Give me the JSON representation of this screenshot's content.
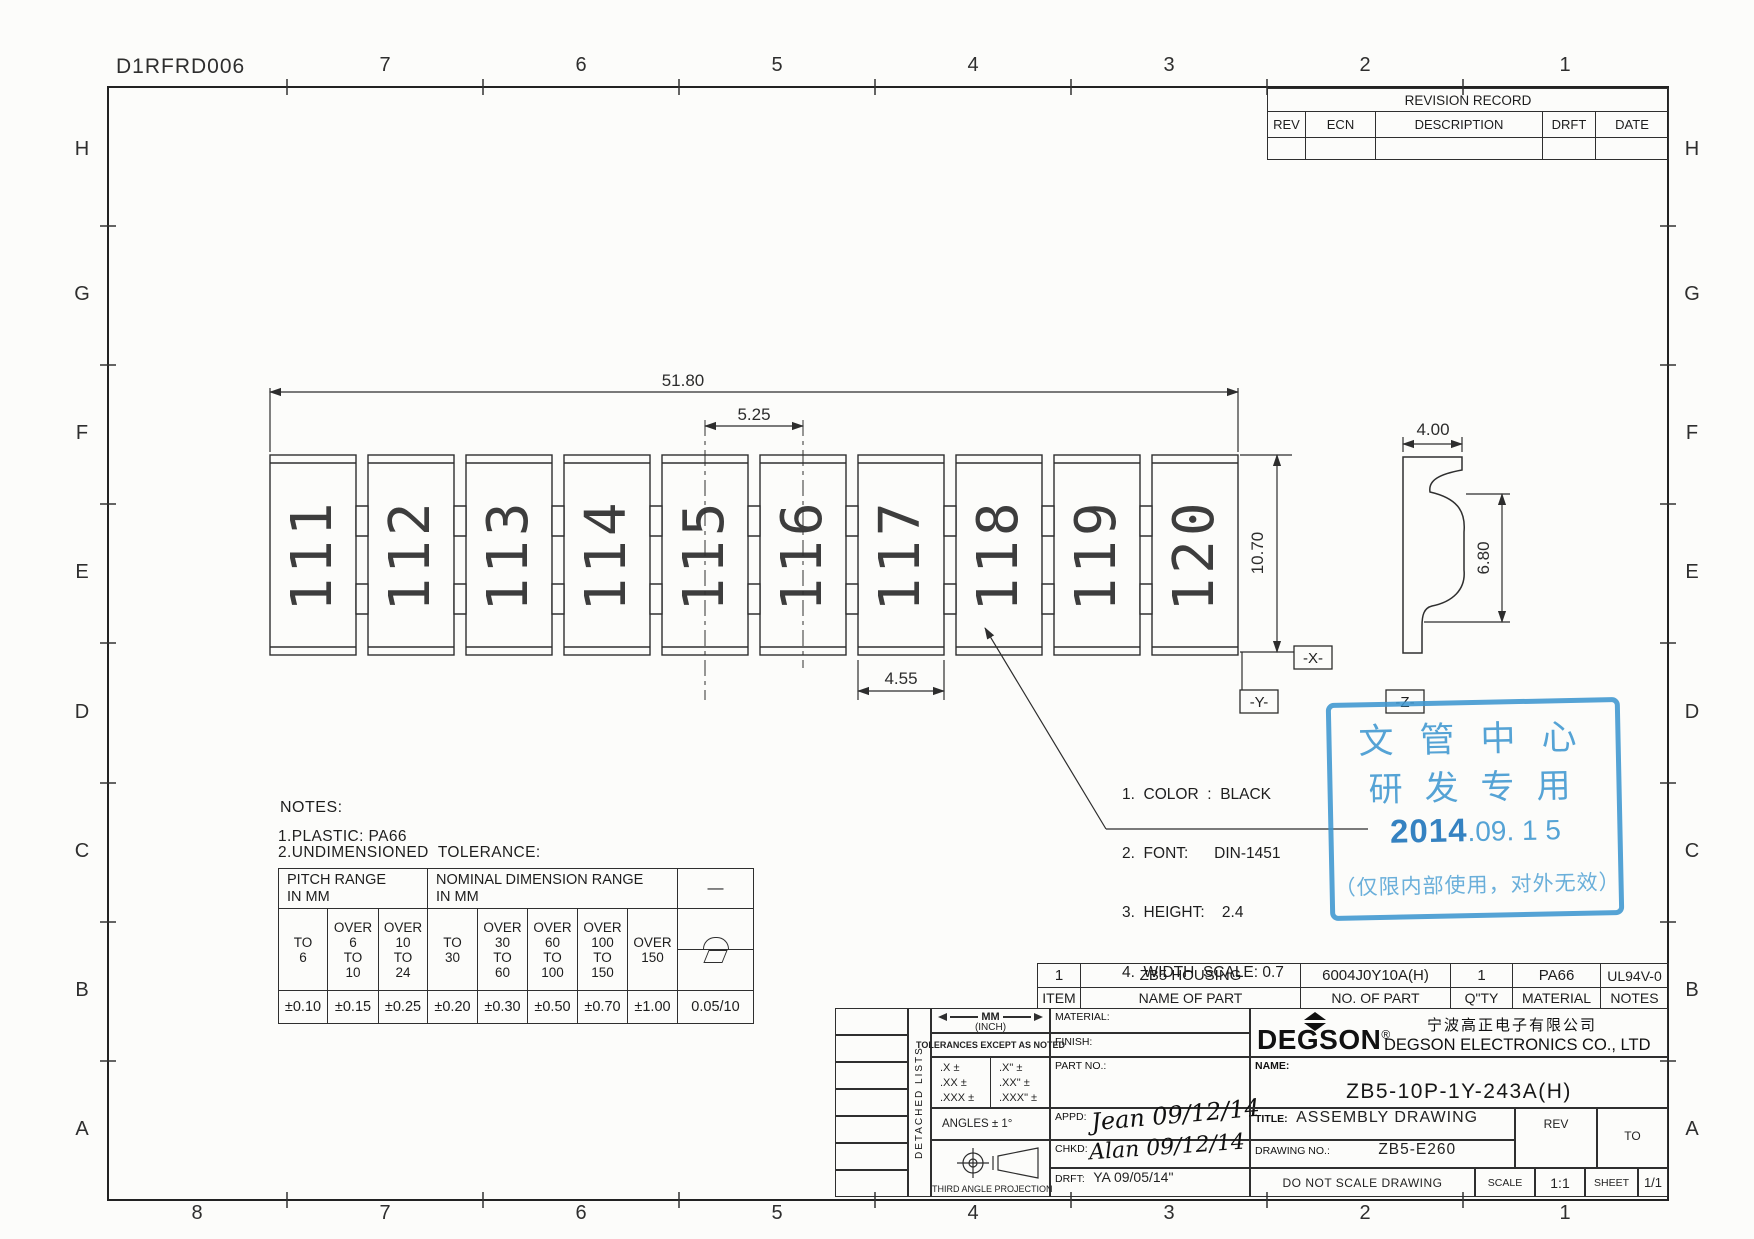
{
  "colors": {
    "line": "#2f2f2f",
    "stamp_blue": "#3e97d0",
    "stamp_date_blue": "#1a72ba"
  },
  "sheet": {
    "doc_number": "D1RFRD006",
    "grid_letters": [
      "H",
      "G",
      "F",
      "E",
      "D",
      "C",
      "B",
      "A"
    ],
    "top_numbers": [
      "7",
      "6",
      "5",
      "4",
      "3",
      "2",
      "1"
    ],
    "bottom_numbers": [
      "8",
      "7",
      "6",
      "5",
      "4",
      "3",
      "2",
      "1"
    ]
  },
  "revision_table": {
    "title": "REVISION RECORD",
    "headers": [
      "REV",
      "ECN",
      "DESCRIPTION",
      "DRFT",
      "DATE"
    ]
  },
  "drawing": {
    "blocks": [
      "111",
      "112",
      "113",
      "114",
      "115",
      "116",
      "117",
      "118",
      "119",
      "120"
    ],
    "dim_total_width": "51.80",
    "dim_pitch": "5.25",
    "dim_height": "10.70",
    "dim_block_width": "4.55",
    "dim_side_width": "4.00",
    "dim_side_height": "6.80",
    "datum_x": "-X-",
    "datum_y": "-Y-",
    "datum_z": "-Z-",
    "marking_notes": [
      "1.  COLOR  :  BLACK",
      "2.  FONT:      DIN-1451",
      "3.  HEIGHT:    2.4",
      "4.  WIDTH  SCALE: 0.7"
    ]
  },
  "notes": {
    "title": "NOTES:",
    "line1": "1.PLASTIC: PA66",
    "line2": "2.UNDIMENSIONED  TOLERANCE:"
  },
  "tolerance_table": {
    "pitch_header": "PITCH  RANGE\nIN  MM",
    "nominal_header": "NOMINAL  DIMENSION  RANGE\nIN  MM",
    "ranges": [
      "TO\n6",
      "OVER\n6\nTO\n10",
      "OVER\n10\nTO\n24",
      "TO\n30",
      "OVER\n30\nTO\n60",
      "OVER\n60\nTO\n100",
      "OVER\n100\nTO\n150",
      "OVER\n150"
    ],
    "values": [
      "±0.10",
      "±0.15",
      "±0.25",
      "±0.20",
      "±0.30",
      "±0.50",
      "±0.70",
      "±1.00",
      "0.05/10"
    ],
    "symbol_dash": "—",
    "symbol_arc": "arc-symbol",
    "symbol_parallelogram": "parallelogram-symbol"
  },
  "parts_table": {
    "row": [
      "1",
      "ZB5 HOUSING",
      "6004J0Y10A(H)",
      "1",
      "PA66",
      "UL94V-0"
    ],
    "headers": [
      "ITEM",
      "NAME OF PART",
      "NO. OF PART",
      "Q\"TY",
      "MATERIAL",
      "NOTES"
    ]
  },
  "title_block": {
    "detached_lists": "DETACHED LISTS",
    "units_mm": "MM",
    "units_inch": "(INCH)",
    "tolerances_note": "TOLERANCES EXCEPT AS NOTED",
    "tol_mm": ".X ±\n.XX ±\n.XXX ±",
    "tol_inch": ".X\" ±\n.XX\" ±\n.XXX\" ±",
    "angles": "ANGLES ± 1°",
    "projection": "THIRD ANGLE PROJECTION",
    "material_label": "MATERIAL:",
    "finish_label": "FINISH:",
    "part_no_label": "PART NO.:",
    "appd_label": "APPD:",
    "appd_value": "Jean 09/12/14",
    "chkd_label": "CHKD:",
    "chkd_value": "Alan 09/12/14",
    "drft_label": "DRFT:",
    "drft_value": "YA 09/05/14\"",
    "brand": "DEGSON",
    "brand_reg": "®",
    "company_cn": "宁波高正电子有限公司",
    "company_en": "DEGSON ELECTRONICS CO., LTD",
    "name_label": "NAME:",
    "name_value": "ZB5-10P-1Y-243A(H)",
    "title_label": "TITLE:",
    "title_value": "ASSEMBLY DRAWING",
    "rev_label": "REV",
    "to_label": "TO",
    "drawing_no_label": "DRAWING NO.:",
    "drawing_no_value": "ZB5-E260",
    "do_not_scale": "DO NOT SCALE DRAWING",
    "scale_label": "SCALE",
    "scale_value": "1:1",
    "sheet_label": "SHEET",
    "sheet_value": "1/1"
  },
  "stamp": {
    "line1": "文管中心",
    "line2": "研发专用",
    "date_bold": "2014",
    "date_rest": ".09. 1 5",
    "note": "（仅限内部使用，对外无效）"
  }
}
